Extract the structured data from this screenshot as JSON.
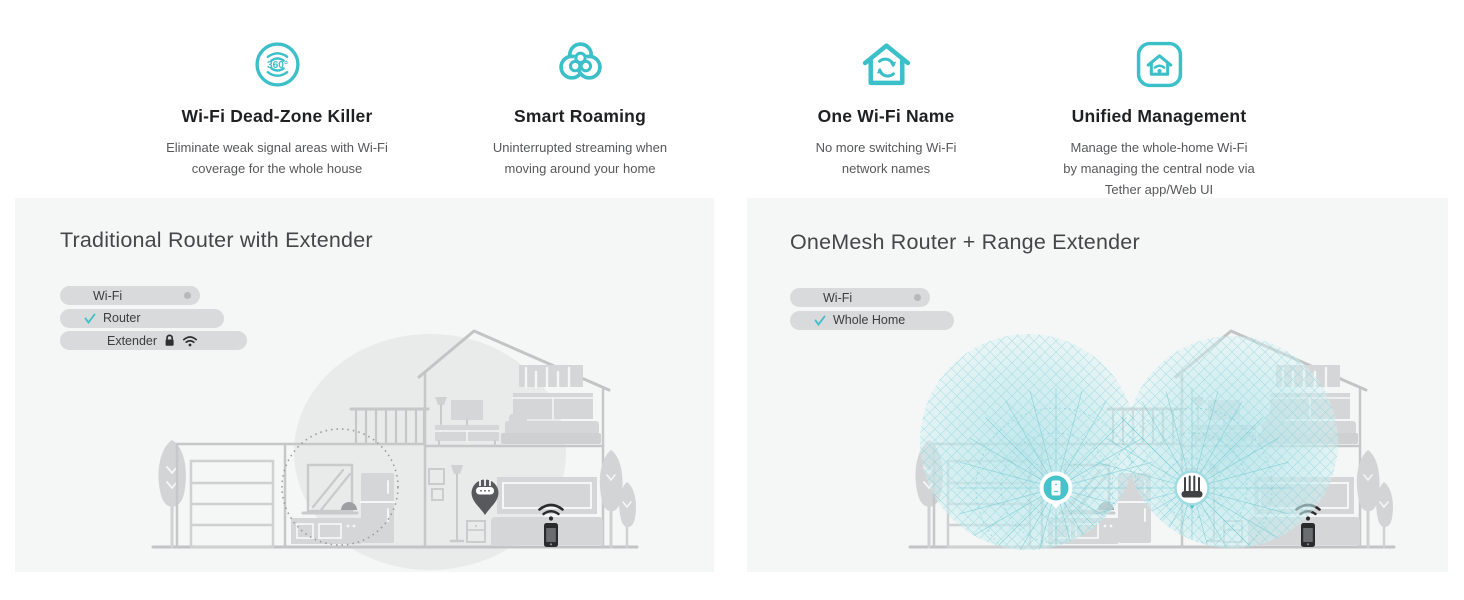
{
  "accent_color": "#3bbfc9",
  "features": [
    {
      "icon": "wifi-360-icon",
      "title": "Wi-Fi Dead-Zone Killer",
      "description": "Eliminate weak signal areas with Wi-Fi coverage for the whole house"
    },
    {
      "icon": "smart-roaming-icon",
      "title": "Smart Roaming",
      "description": "Uninterrupted streaming when moving around your home"
    },
    {
      "icon": "one-wifi-name-icon",
      "title": "One Wi-Fi Name",
      "description": "No more switching Wi-Fi network names"
    },
    {
      "icon": "unified-management-icon",
      "title": "Unified Management",
      "description": "Manage the whole-home Wi-Fi by managing the central node via Tether app/Web UI"
    }
  ],
  "panels": {
    "left": {
      "title": "Traditional Router with Extender",
      "legend": [
        {
          "label": "Wi-Fi",
          "indicator": "status-dot"
        },
        {
          "label": "Router",
          "indicator": "check"
        },
        {
          "label": "Extender",
          "indicator": "lock-icon wifi-icon"
        }
      ]
    },
    "right": {
      "title": "OneMesh Router + Range Extender",
      "legend": [
        {
          "label": "Wi-Fi",
          "indicator": "status-dot"
        },
        {
          "label": "Whole Home",
          "indicator": "check"
        }
      ]
    }
  }
}
